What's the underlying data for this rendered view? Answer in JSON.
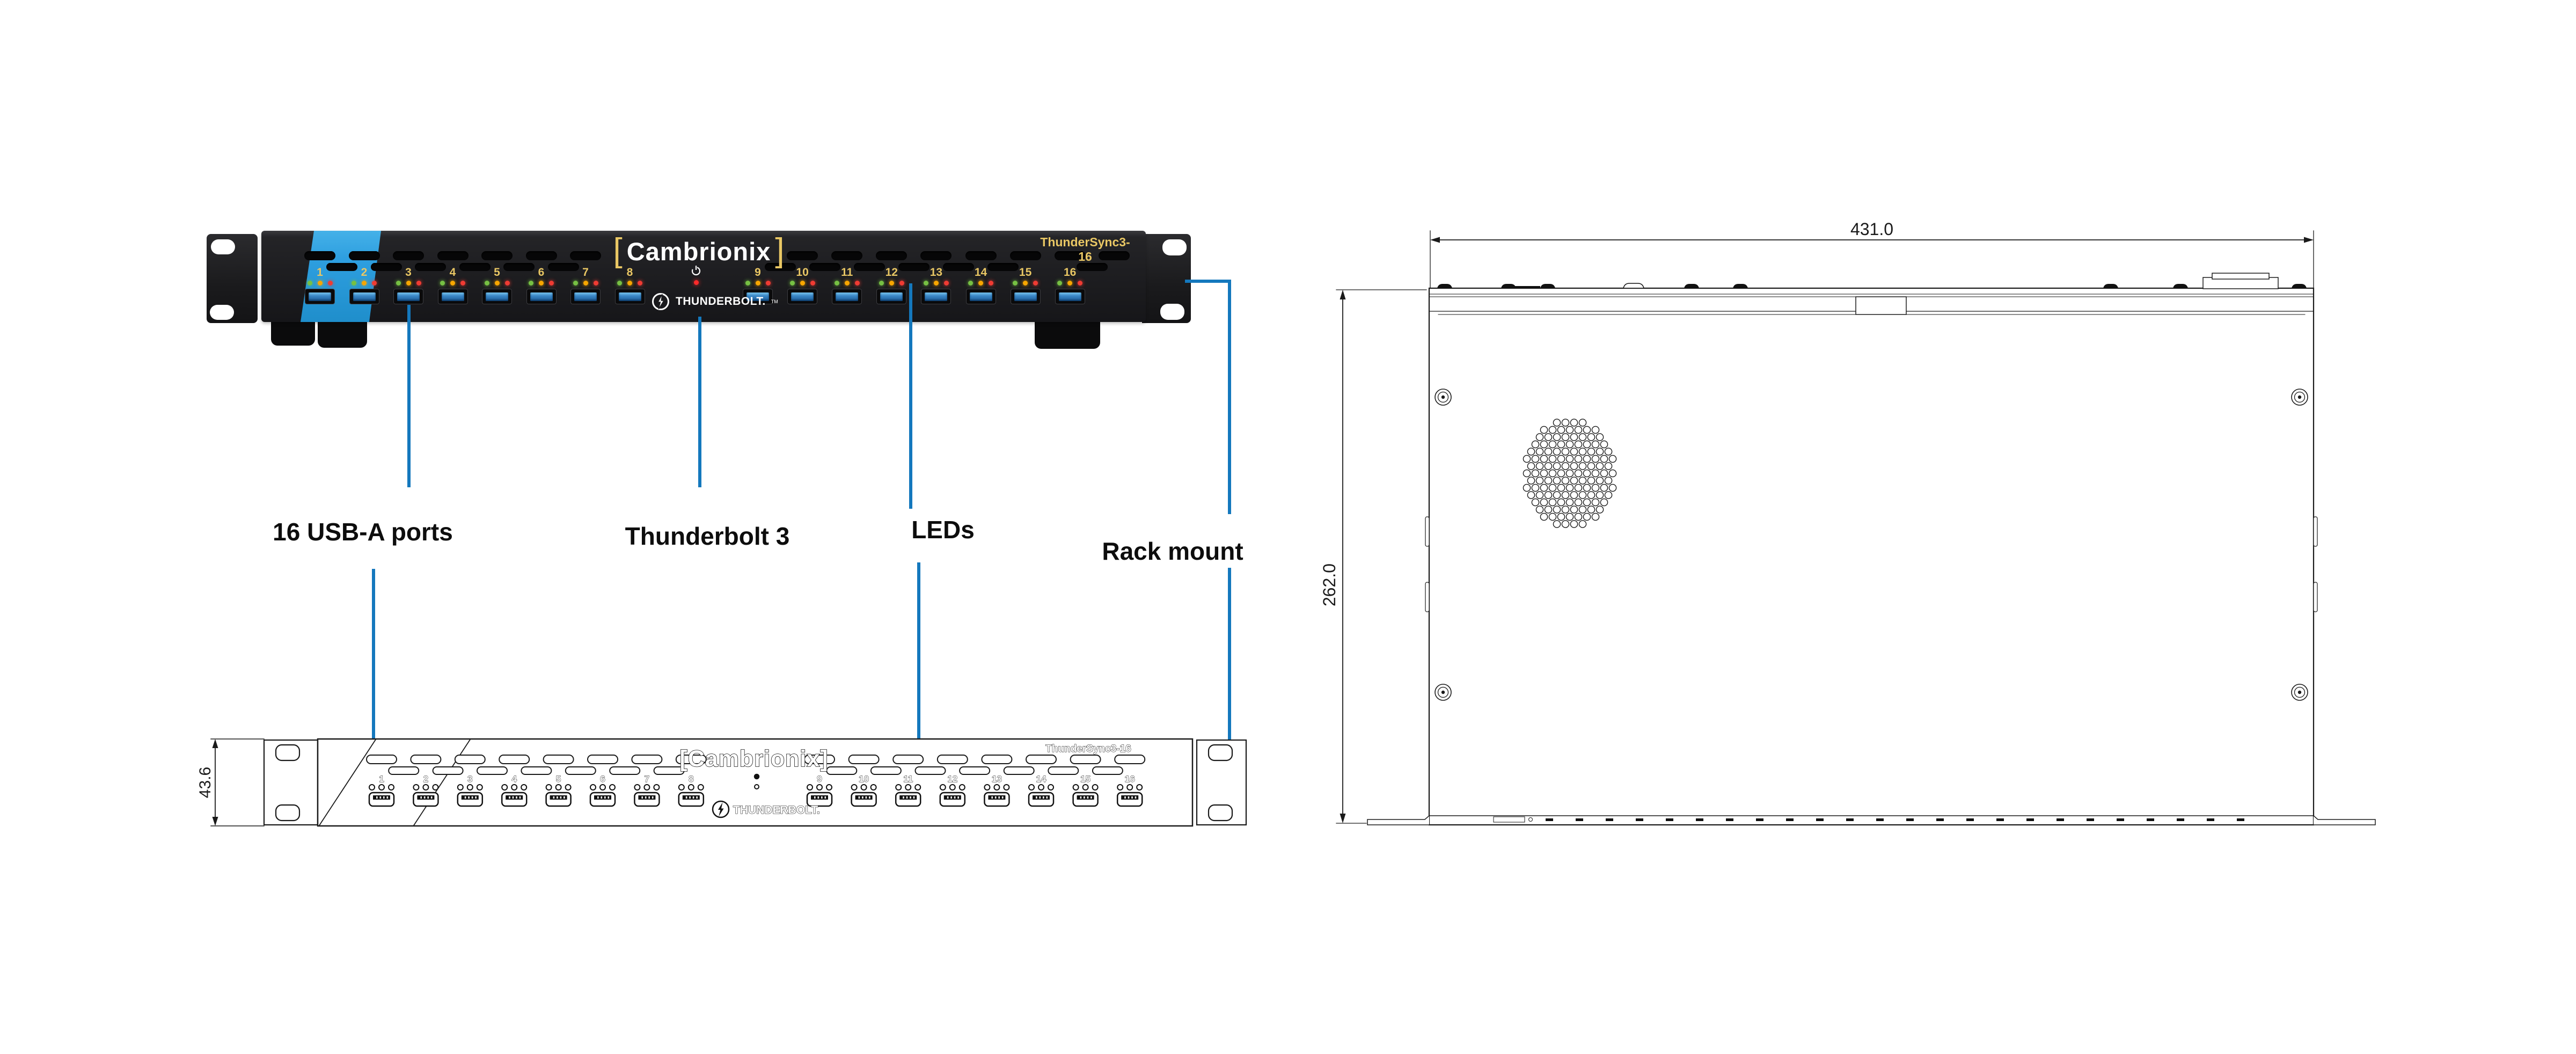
{
  "device": {
    "brand": "Cambrionix",
    "bracket_left": "[",
    "bracket_right": "]",
    "model": "ThunderSync3-16",
    "thunderbolt_label": "THUNDERBOLT.",
    "trademark": "TM",
    "port_labels": [
      "1",
      "2",
      "3",
      "4",
      "5",
      "6",
      "7",
      "8",
      "9",
      "10",
      "11",
      "12",
      "13",
      "14",
      "15",
      "16"
    ]
  },
  "callouts": {
    "usb": {
      "label": "16 USB-A ports"
    },
    "thunderbolt": {
      "label": "Thunderbolt 3"
    },
    "leds": {
      "label": "LEDs"
    },
    "rack": {
      "label": "Rack mount"
    }
  },
  "front_drawing": {
    "dimension_height": "43.6",
    "brand": "[Cambrionix]",
    "model": "ThunderSync3-16",
    "thunderbolt_label": "THUNDERBOLT."
  },
  "top_drawing": {
    "dimension_width": "431.0",
    "dimension_depth": "262.0"
  },
  "colors": {
    "callout": "#1478bd",
    "stripe": "#2e9fe0",
    "panel_yellow": "#e9c764",
    "led_green": "#76c043",
    "led_amber": "#f7a600",
    "led_red": "#ef3b33",
    "line_dark": "#1a1a1a"
  }
}
